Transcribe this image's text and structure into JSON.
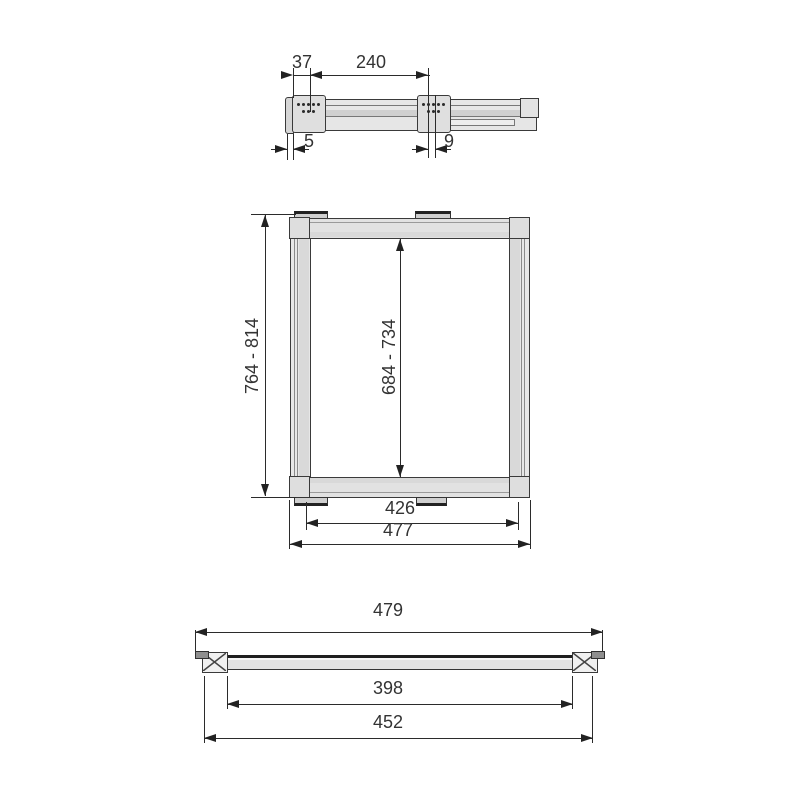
{
  "diagram": {
    "views": {
      "side": {
        "dims": {
          "bracket_offset": "37",
          "bracket_spacing": "240",
          "front_gap": "5",
          "rear_gap": "9"
        }
      },
      "front": {
        "dims": {
          "overall_height": "764 - 814",
          "inner_height": "684 - 734",
          "inner_width": "426",
          "overall_width": "477"
        }
      },
      "plan": {
        "dims": {
          "overall_length": "479",
          "inner_length": "398",
          "fixing_length": "452"
        }
      }
    },
    "colors": {
      "line": "#2b2b2b",
      "part_outline": "#3a3a3a",
      "fill_light": "#e5e5e5",
      "fill_mid": "#d4d4d4",
      "fill_dark": "#8e8e8e",
      "background": "#ffffff",
      "text": "#333333"
    }
  }
}
